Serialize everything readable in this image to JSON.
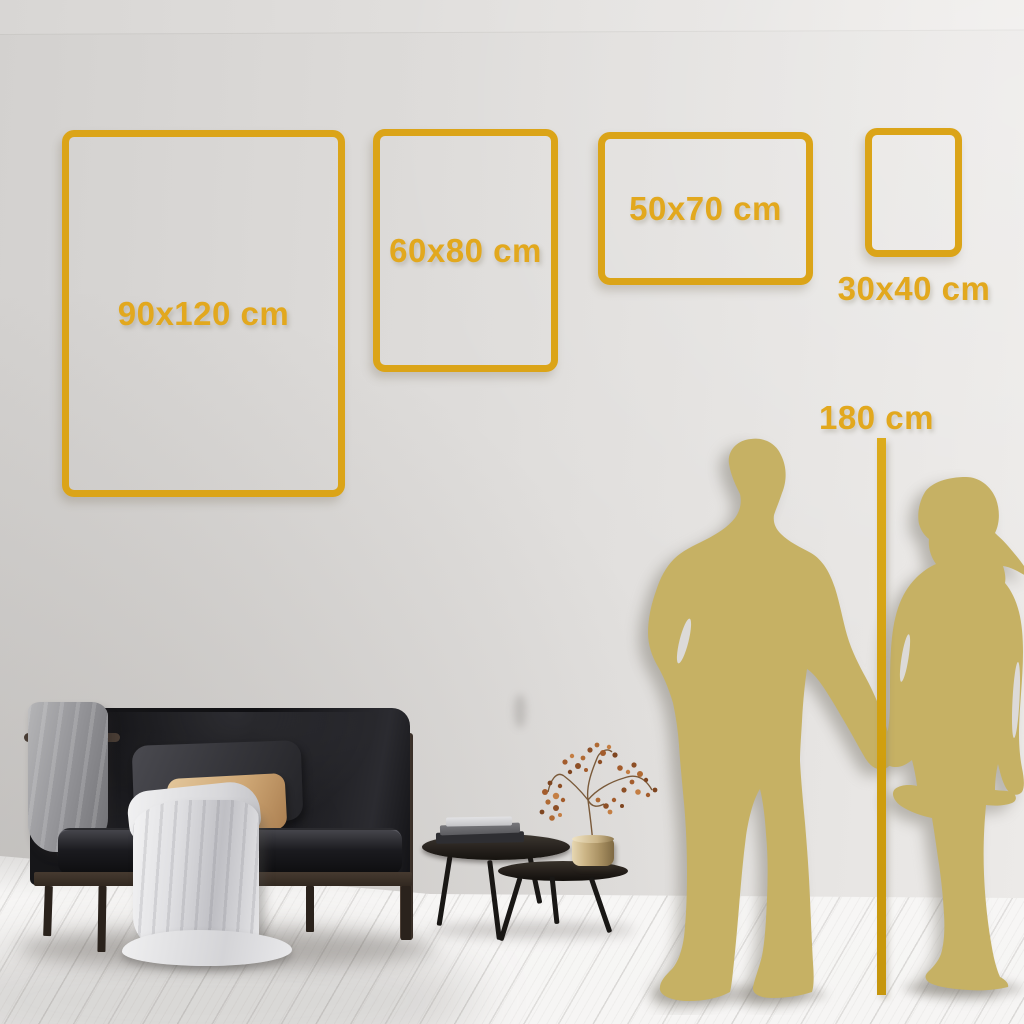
{
  "size_guide": {
    "frames": [
      {
        "id": "90x120",
        "label": "90x120 cm"
      },
      {
        "id": "60x80",
        "label": "60x80 cm"
      },
      {
        "id": "50x70",
        "label": "50x70 cm"
      },
      {
        "id": "30x40",
        "label": "30x40 cm"
      }
    ],
    "height_marker": {
      "label": "180 cm",
      "height_cm": 180
    }
  },
  "accent": {
    "frame_gold": "#dba418",
    "text_gold": "#e2a81e",
    "line_gold": "#d09f10",
    "silhouette_gold": "#c6b164"
  }
}
